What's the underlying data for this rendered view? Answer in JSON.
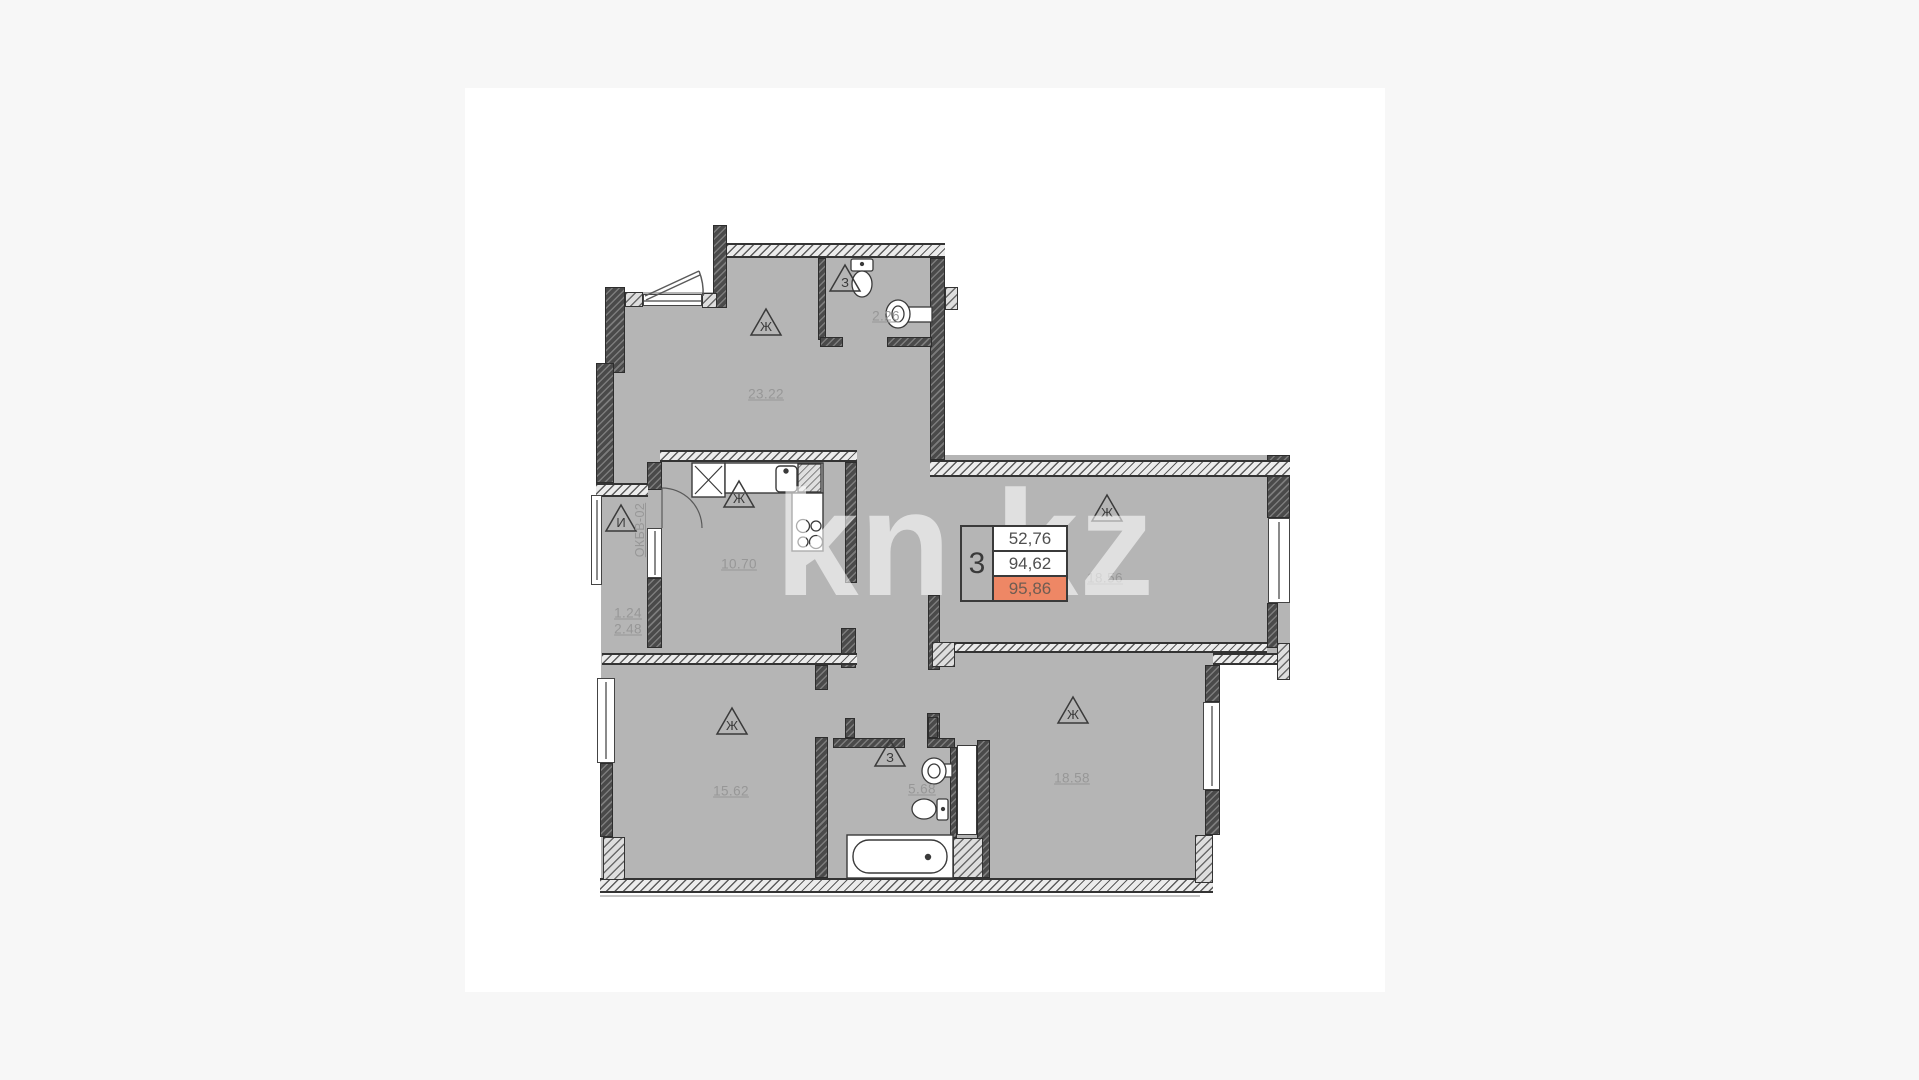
{
  "watermark": {
    "text": "kn.kz"
  },
  "info_box": {
    "room_count": "3",
    "area_living": "52,76",
    "area_apartment": "94,62",
    "area_total": "95,86",
    "highlight_color": "#ee8765"
  },
  "rooms": {
    "living": {
      "area": "23.22",
      "marker": "Ж"
    },
    "bathroom_top": {
      "area": "2.26",
      "marker": "З"
    },
    "kitchen": {
      "area": "10.70",
      "marker": "Ж"
    },
    "balcony": {
      "area_small": "1.24",
      "area_full": "2.48",
      "marker": "И",
      "window_code": "ОКБВ-02"
    },
    "room_right": {
      "area": "18.56",
      "marker": "Ж"
    },
    "room_bottom_left": {
      "area": "15.62",
      "marker": "Ж"
    },
    "bathroom_bottom": {
      "area": "5.68",
      "marker": "З"
    },
    "room_bottom_right": {
      "area": "18.58",
      "marker": "Ж"
    }
  },
  "colors": {
    "floor": "#b5b5b5",
    "wall": "#4a4a4a",
    "accent": "#ee8765",
    "label": "#979797"
  }
}
